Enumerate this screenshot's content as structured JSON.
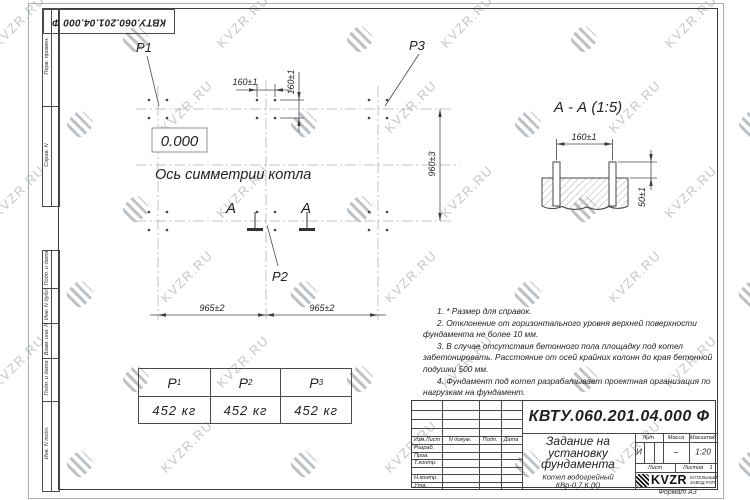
{
  "watermark": {
    "text": "KVZR.RU"
  },
  "top_stamp": {
    "doc_number": "КВТУ.060.201.04.000  Ф"
  },
  "side_labels": {
    "perv": "Перв. примен.",
    "sprav": "Справ. N",
    "podp1": "Подп. и дата",
    "inv_dubl": "Инв. N дубл.",
    "vzam": "Взам. инв. N",
    "podp2": "Подп. и дата",
    "inv_podl": "Инв. N подл."
  },
  "plan": {
    "label_p1": "P1",
    "label_p2": "P2",
    "label_p3": "P3",
    "zero_mark": "0.000",
    "axis_label": "Ось симметрии котла",
    "dim_bolt_h": "160±1",
    "dim_bolt_v": "160±1",
    "dim_width": "960±3",
    "dim_span_left": "965±2",
    "dim_span_right": "965±2",
    "section_letter_left": "А",
    "section_letter_right": "А"
  },
  "section_view": {
    "title": "А - А (1:5)",
    "dim_bolts": "160±1",
    "dim_height": "50±1"
  },
  "notes": [
    "1. * Размер для справок.",
    "2. Отклонение от горизонтального уровня верхней поверхности фундамента не более 10 мм.",
    "3. В случае отсутствия бетонного пола площадку под котел забетонировать. Расстояние от осей крайних колонн до края бетонной подушки 500 мм.",
    "4. Фундамент под котел разрабатывает проектная организация по нагрузкам на фундамент."
  ],
  "load_table": {
    "columns": [
      {
        "head": "P",
        "sub": "1",
        "value": "452 кг"
      },
      {
        "head": "P",
        "sub": "2",
        "value": "452 кг"
      },
      {
        "head": "P",
        "sub": "3",
        "value": "452 кг"
      }
    ]
  },
  "title_block": {
    "doc_number": "КВТУ.060.201.04.000  Ф",
    "title_lines": [
      "Задание на",
      "установку",
      "фундамента"
    ],
    "product_lines": [
      "Котел водогрейный",
      "КВр-0,7 К (К)"
    ],
    "col_izm": "Изм.Лист",
    "col_ndoc": "N докум.",
    "col_podp": "Подп.",
    "col_data": "Дата",
    "row_razrab": "Разраб.",
    "row_prov": "Пров.",
    "row_tkontr": "Т.контр.",
    "row_nkontr": "Н.контр.",
    "row_utv": "Утв.",
    "lit_label": "Лит.",
    "lit_value": "И",
    "mass_label": "Масса",
    "mass_value": "–",
    "scale_label": "Масштаб",
    "scale_value": "1:20",
    "sheet_label": "Лист",
    "sheets_label": "Листов",
    "sheets_value": "1",
    "logo_text": "KVZR",
    "logo_caption1": "КОТЕЛЬНЫЙ",
    "logo_caption2": "ЗАВОД РЭП",
    "format_label": "Формат А3"
  }
}
